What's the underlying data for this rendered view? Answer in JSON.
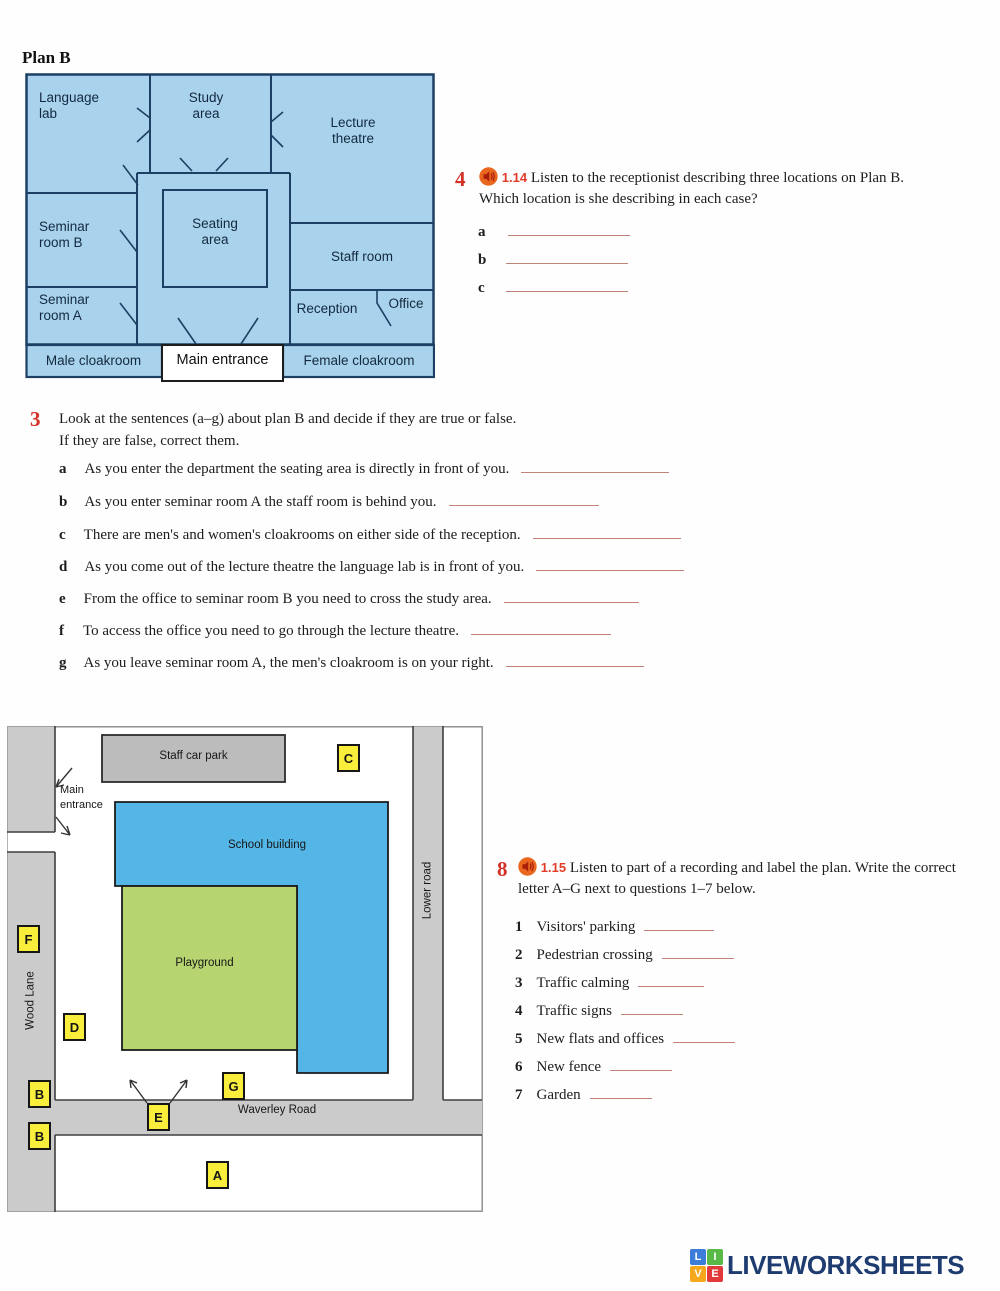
{
  "plan": {
    "title": "Plan B",
    "rooms": {
      "language_lab": "Language lab",
      "study_area": "Study area",
      "lecture_theatre": "Lecture theatre",
      "seminar_room_b": "Seminar room B",
      "seating_area": "Seating area",
      "staff_room": "Staff room",
      "seminar_room_a": "Seminar room A",
      "reception": "Reception",
      "office": "Office",
      "male_cloakroom": "Male cloakroom",
      "main_entrance": "Main entrance",
      "female_cloakroom": "Female cloakroom"
    }
  },
  "exercise4": {
    "number": "4",
    "track": "1.14",
    "instructions_line1": "Listen to the receptionist describing three locations on Plan B.",
    "instructions_line2": "Which location is she describing in each case?",
    "items": [
      {
        "label": "a"
      },
      {
        "label": "b"
      },
      {
        "label": "c"
      }
    ]
  },
  "exercise3": {
    "number": "3",
    "instructions_line1": "Look at the sentences (a–g) about plan B and decide if they are true or false.",
    "instructions_line2": "If they are false, correct them.",
    "items": [
      {
        "label": "a",
        "text": "As you enter the department the seating area is directly in front of you."
      },
      {
        "label": "b",
        "text": "As you enter seminar room A the staff room is behind you."
      },
      {
        "label": "c",
        "text": "There are men's and women's cloakrooms on either side of the reception."
      },
      {
        "label": "d",
        "text": "As you come out of the lecture theatre the language lab is in front of you."
      },
      {
        "label": "e",
        "text": "From the office to seminar room B you need to cross the study area."
      },
      {
        "label": "f",
        "text": "To access the office you need to go through the lecture theatre."
      },
      {
        "label": "g",
        "text": "As you leave seminar room A, the men's cloakroom is on your right."
      }
    ]
  },
  "map": {
    "labels": {
      "staff_car_park": "Staff car park",
      "main_entrance": "Main entrance",
      "school_building": "School building",
      "playground": "Playground",
      "wood_lane": "Wood Lane",
      "lower_road": "Lower road",
      "waverley_road": "Waverley Road"
    },
    "markers": [
      {
        "letter": "C"
      },
      {
        "letter": "F"
      },
      {
        "letter": "D"
      },
      {
        "letter": "B"
      },
      {
        "letter": "B"
      },
      {
        "letter": "E"
      },
      {
        "letter": "G"
      },
      {
        "letter": "A"
      }
    ]
  },
  "exercise8": {
    "number": "8",
    "track": "1.15",
    "instructions_line1": "Listen to part of a recording and label the plan. Write the correct",
    "instructions_line2": "letter A–G next to questions 1–7 below.",
    "items": [
      {
        "num": "1",
        "text": "Visitors' parking"
      },
      {
        "num": "2",
        "text": "Pedestrian crossing"
      },
      {
        "num": "3",
        "text": "Traffic calming"
      },
      {
        "num": "4",
        "text": "Traffic signs"
      },
      {
        "num": "5",
        "text": "New flats and offices"
      },
      {
        "num": "6",
        "text": "New fence"
      },
      {
        "num": "7",
        "text": "Garden"
      }
    ]
  },
  "footer": {
    "logo_text": "LIVEWORKSHEETS",
    "logo_letters": [
      "L",
      "I",
      "V",
      "E"
    ]
  },
  "colors": {
    "accent_red": "#d23227",
    "track_red": "#e23b28",
    "underline": "#c1837a",
    "plan_fill": "#a9d3ec",
    "plan_line": "#1c3f63",
    "school_blue": "#54b6e6",
    "playground_green": "#b6d470",
    "road_gray": "#cbcbcb",
    "carpark_gray": "#bcbcbc",
    "marker_yellow": "#f9ee3b",
    "logo_navy": "#1e3c70"
  }
}
